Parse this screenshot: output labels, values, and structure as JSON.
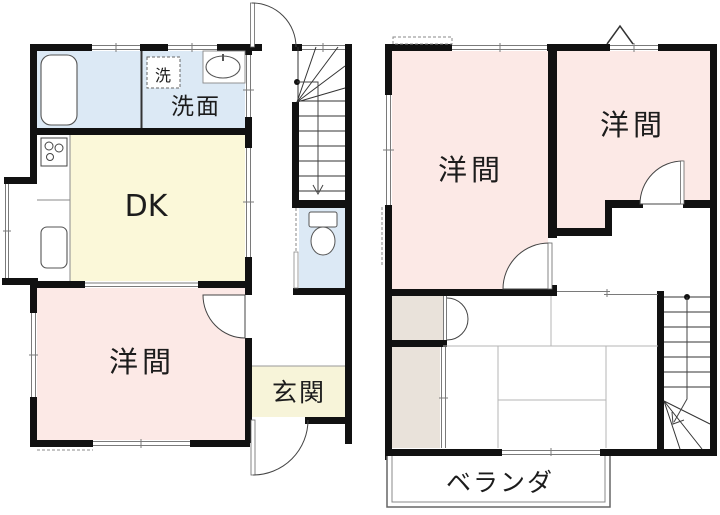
{
  "plan": {
    "floor1": {
      "labels": {
        "washroom": "洗面",
        "washer_box": "洗",
        "dining_kitchen": "DK",
        "western_room": "洋間",
        "entrance": "玄関"
      }
    },
    "floor2": {
      "labels": {
        "western_room_left": "洋間",
        "western_room_right": "洋間",
        "veranda": "ベランダ"
      }
    },
    "colors": {
      "wall": "#111111",
      "room_pink": "#fce9e6",
      "room_yellow": "#fbf8d9",
      "room_blue": "#dce9f5",
      "entrance_yellow": "#f7f4d9",
      "closet_beige": "#e9e2da"
    }
  }
}
